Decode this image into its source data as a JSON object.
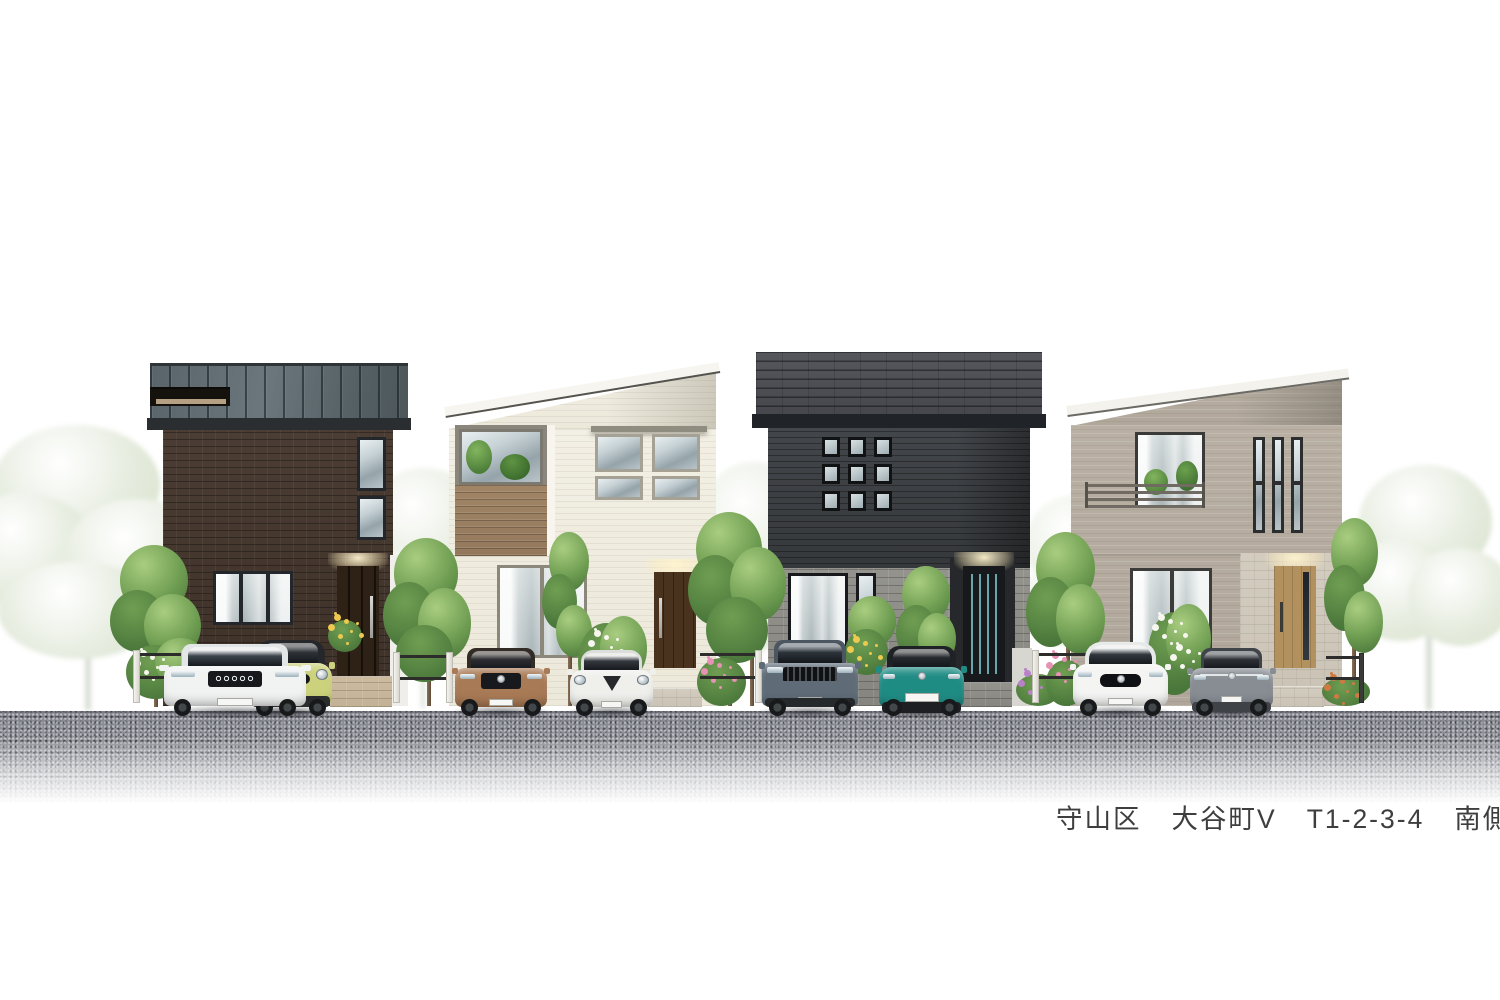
{
  "caption": {
    "full": "守山区　大谷町V　T1-2-3-4　南側",
    "district": "守山区",
    "town": "大谷町V",
    "lot_numbers": "T1-2-3-4",
    "elevation_side": "南側"
  },
  "palette": {
    "background": "#ffffff",
    "asphalt": "#8f9198",
    "curb": "#f7f7f5",
    "text": "#3e3e3e"
  },
  "houses": [
    {
      "id": "house-1",
      "siding": "dark-brown-brick",
      "wall": "#45382f",
      "roof": "#5c676c",
      "fascia": "#2b2e30",
      "door": "#2e2115",
      "frame": "#23262a",
      "stone": "#b28a5c"
    },
    {
      "id": "house-2",
      "siding": "cream-siding",
      "wall": "#f0ecdf",
      "roof": "#f6f5ef",
      "fascia": "#8f8c80",
      "door": "#49331f",
      "frame": "#9a978a",
      "stone": "#c9b89d",
      "balcony_wood": "#9a8064"
    },
    {
      "id": "house-3",
      "siding": "charcoal-siding",
      "wall": "#3d4043",
      "roof": "#4b4d53",
      "fascia": "#202327",
      "door": "#17191c",
      "frame": "#141619",
      "stone": "#8d8c85"
    },
    {
      "id": "house-4",
      "siding": "greige-siding",
      "wall": "#b5ac9f",
      "roof": "#f3f2ec",
      "fascia": "#e8e6df",
      "door": "#b2915f",
      "frame": "#323436",
      "stone": "#cfc8ba"
    }
  ],
  "cars": [
    {
      "id": "car-lime-mini",
      "body": "#ccd27b",
      "roof": "#25272a",
      "glass": "#2e3338",
      "bumper": "#2a2c2e"
    },
    {
      "id": "car-white-suv",
      "body": "#f1f2f2",
      "roof": "#e3e6e7",
      "glass": "#3c444c",
      "bumper": "#caccce"
    },
    {
      "id": "car-bronze-suv",
      "body": "#a87a55",
      "roof": "#332b26",
      "glass": "#2b2d32",
      "bumper": "#2e2a27"
    },
    {
      "id": "car-white-hatch",
      "body": "#efefec",
      "roof": "#dcdedb",
      "glass": "#34383e",
      "bumper": "#dadad7"
    },
    {
      "id": "car-slate-suv",
      "body": "#5f6c78",
      "roof": "#4b5660",
      "glass": "#2c333a",
      "bumper": "#26292c"
    },
    {
      "id": "car-teal-hatch",
      "body": "#1f8c84",
      "roof": "#1f2225",
      "glass": "#262a2e",
      "bumper": "#1d1f22"
    },
    {
      "id": "car-white-sedan",
      "body": "#f4f4f3",
      "roof": "#e8eaea",
      "glass": "#31373d",
      "bumper": "#3a3d40"
    },
    {
      "id": "car-gray-crossover",
      "body": "#878d93",
      "roof": "#3f4449",
      "glass": "#2d3136",
      "bumper": "#3f4347"
    }
  ],
  "vegetation": {
    "leaf_light": "#a9cd80",
    "leaf_mid": "#6f9e52",
    "leaf_dark": "#49763a",
    "faded_light": "#e6ecdf",
    "faded_dark": "#d7e2cc",
    "flower_white": "#f7f7ef",
    "flower_pink": "#e791b4",
    "flower_yellow": "#ecc94f",
    "flower_purple": "#b981c9",
    "flower_orange": "#cf7a43"
  }
}
